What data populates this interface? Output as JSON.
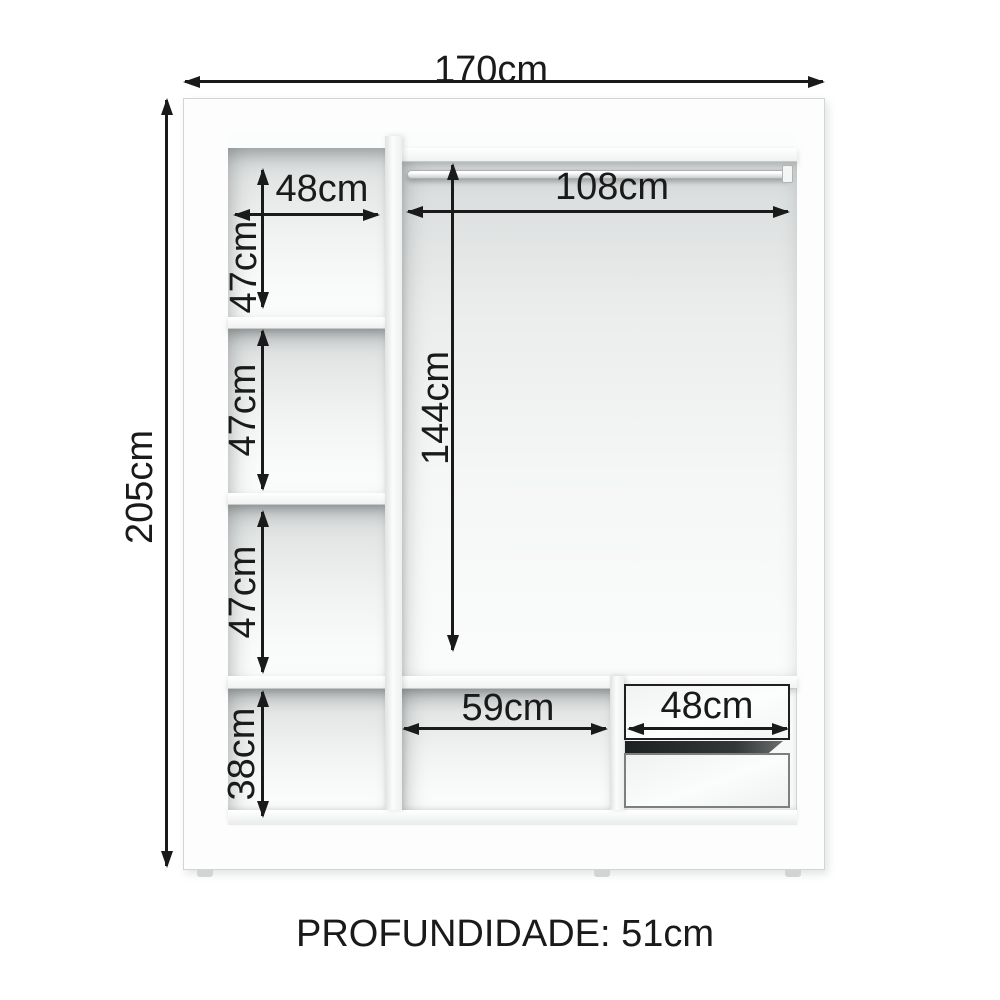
{
  "diagram": {
    "type": "wardrobe-interior-dimension-diagram",
    "colors": {
      "ink": "#1a1a1a",
      "background": "#ffffff",
      "cabinet_white": "#fbfcfc",
      "shadow_gray": "#cfd3d3",
      "drawer_gap_dark": "#242727"
    },
    "labels": {
      "overall_width": "170cm",
      "overall_height": "205cm",
      "left_top_width": "48cm",
      "left_compartment_1_height": "47cm",
      "left_compartment_2_height": "47cm",
      "left_compartment_3_height": "47cm",
      "left_bottom_height": "38cm",
      "rod_section_width": "108cm",
      "rod_section_height": "144cm",
      "bottom_middle_width": "59cm",
      "drawer_width": "48cm"
    },
    "footer_label": "PROFUNDIDADE: 51cm"
  }
}
